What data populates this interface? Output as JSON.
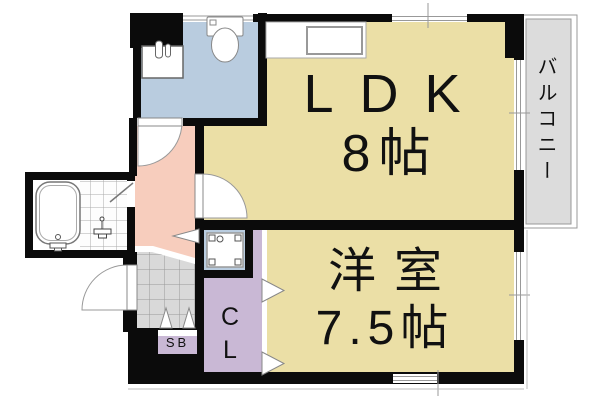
{
  "plan": {
    "labels": {
      "ldk": "LDK",
      "ldk_size": "8帖",
      "western": "洋室",
      "western_size": "7.5帖",
      "balcony": "バルコニー",
      "closet": "CL",
      "shoebox": "SB"
    },
    "rooms": [
      {
        "name": "LDK",
        "size": "8帖"
      },
      {
        "name": "洋室",
        "size": "7.5帖"
      },
      {
        "name": "バルコニー",
        "size": ""
      },
      {
        "name": "CL",
        "size": ""
      },
      {
        "name": "SB",
        "size": ""
      }
    ],
    "fixtures": [
      "toilet",
      "washbasin",
      "kitchen-counter-sink",
      "bathtub",
      "shower",
      "washing-machine-pan",
      "entrance-tile-floor"
    ],
    "colors": {
      "room_floor": "#EBDFA6",
      "wet_area": "#B9CCDF",
      "hallway": "#F7CDBD",
      "storage": "#C9B8D5",
      "balcony": "#DCDCDC",
      "entrance_tile": "#D9D9D9",
      "wall": "#0B0B0B",
      "thin_line": "#999999"
    }
  }
}
